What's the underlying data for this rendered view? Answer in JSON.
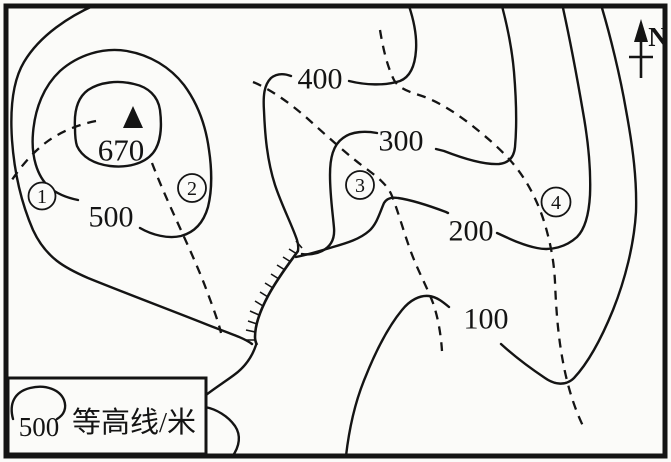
{
  "map": {
    "north_label": "N",
    "peak": {
      "elevation": "670"
    },
    "contour_labels": {
      "c400": "400",
      "c300": "300",
      "c500": "500",
      "c200": "200",
      "c100": "100"
    },
    "markers": {
      "m1": "1",
      "m2": "2",
      "m3": "3",
      "m4": "4"
    },
    "legend": {
      "sample_value": "500",
      "label": "等高线/米"
    },
    "colors": {
      "line": "#141414",
      "paper": "#fbfbf9"
    }
  }
}
